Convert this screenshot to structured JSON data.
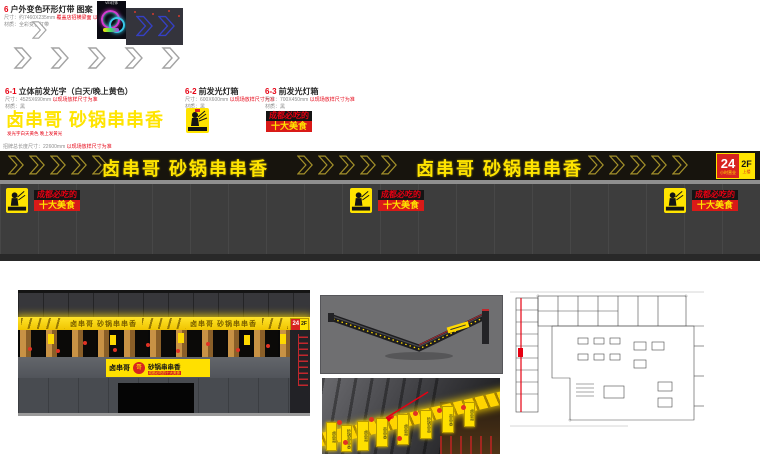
{
  "colors": {
    "accent_red": "#e60012",
    "sign_yellow": "#ffe400",
    "banner_black": "#17140d",
    "panel_gray": "#3d3d3d"
  },
  "section6": {
    "num": "6",
    "title": "户外变色环形灯带 图案",
    "spec1": "尺寸：约7460X235mm",
    "spec1_red": "覆盖店招横梁面 以现场放样尺寸为准",
    "spec2": "材质：全彩变色灯带",
    "neon_caption": "VEI灯饰"
  },
  "section61": {
    "num": "6-1",
    "title": "立体前发光字（白天/晚上黄色）",
    "spec1": "尺寸：4525X690mm",
    "spec1_red": "以现场放样尺寸为准",
    "spec2": "材质：黑",
    "headline": "卤串哥  砂锅串串香",
    "note": "发光字白天黄色 晚上发黄光"
  },
  "section62": {
    "num": "6-2",
    "title": "前发光灯箱",
    "spec1": "尺寸：600X600mm",
    "spec1_red": "以现场放样尺寸为准",
    "spec2": "材质：黑"
  },
  "section63": {
    "num": "6-3",
    "title": "前发光灯箱",
    "spec1": "尺寸：700X450mm",
    "spec1_red": "以现场放样尺寸为准",
    "spec2": "材质：黑"
  },
  "food_badge": {
    "line1": "成都必吃的",
    "line2": "十大美食"
  },
  "logo_badge": {
    "text": "卤串哥"
  },
  "banner": {
    "spec": "招牌总长度尺寸：22600mm",
    "spec_red": "以现场放样尺寸为准",
    "text1": "卤串哥  砂锅串串香",
    "text2": "卤串哥  砂锅串串香",
    "badge24": "24",
    "badge24_sub": "小时营业",
    "badge2f": "2F",
    "badge2f_sub": "上楼"
  },
  "storefront": {
    "band_text1": "卤串哥 砂锅串串香",
    "band_text2": "卤串哥 砂锅串串香",
    "badge24": "24",
    "badge2f": "2F",
    "sign_left": "卤串哥",
    "sign_logo": "哥",
    "sign_right": "砂锅串串香",
    "sign_sub": "成都必吃的十大美食"
  },
  "closeup": {
    "signs": [
      "卤串哥",
      "砂锅串串香",
      "卤串哥",
      "串串香",
      "卤串哥",
      "砂锅串串",
      "串串香",
      "卤串哥"
    ]
  }
}
